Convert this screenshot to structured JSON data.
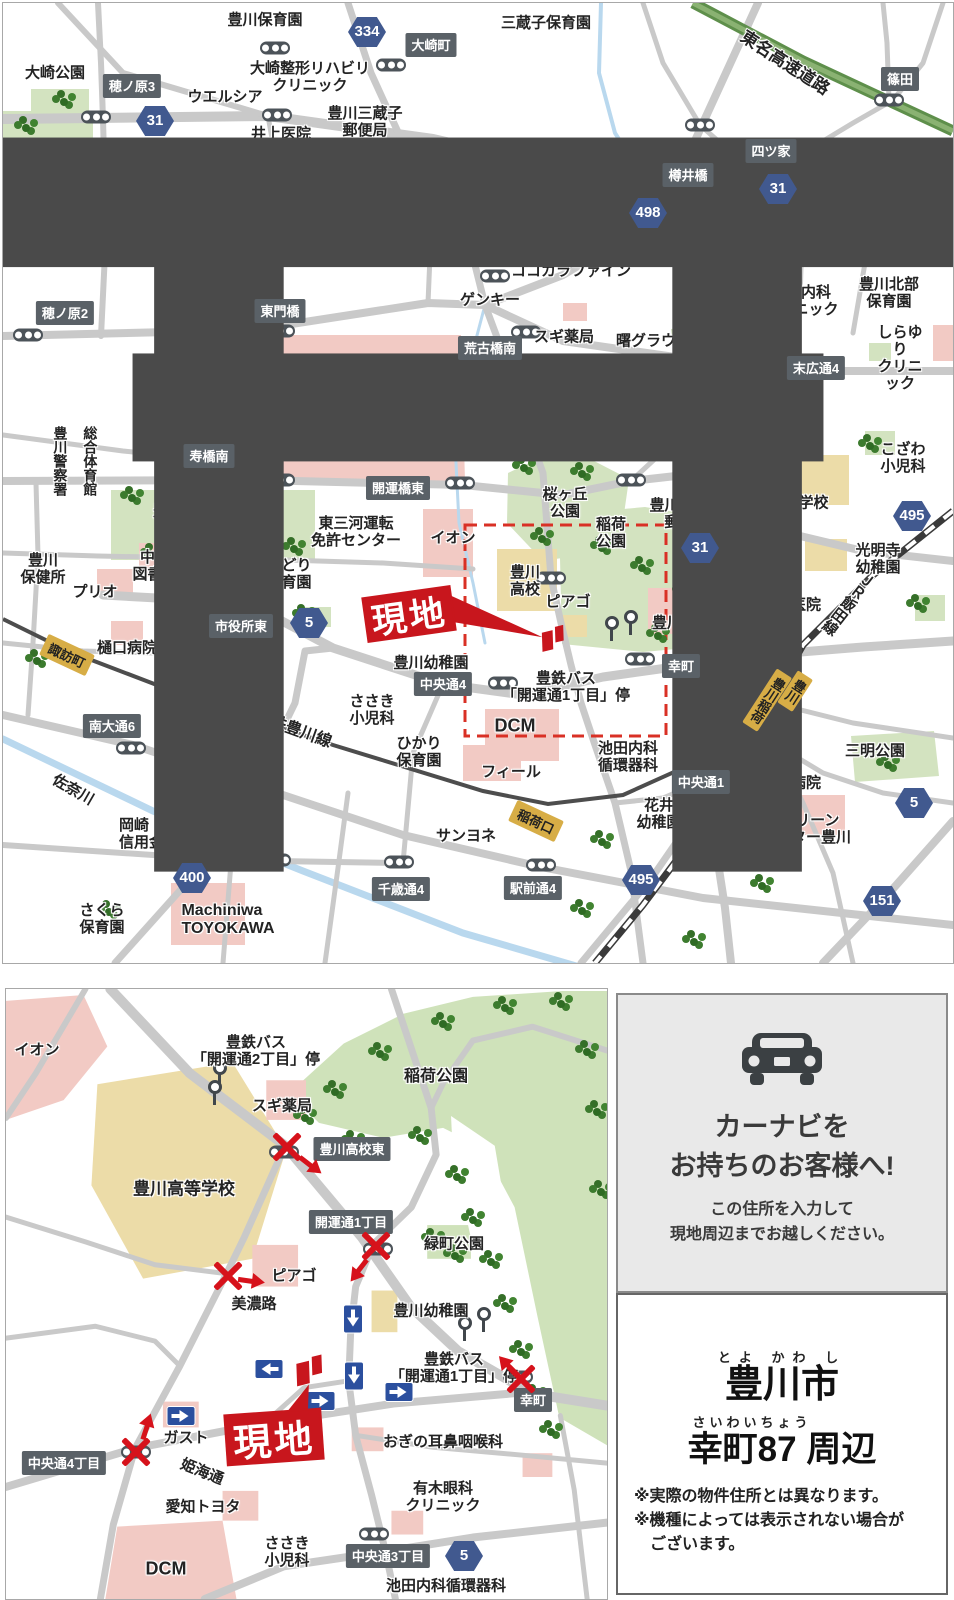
{
  "main_map": {
    "compass": "N",
    "site_label": "現地",
    "labels": [
      {
        "t": "豊川保育園",
        "x": 262,
        "y": 17
      },
      {
        "t": "大崎整形リハビリ\nクリニック",
        "x": 307,
        "y": 74
      },
      {
        "t": "三蔵子保育園",
        "x": 543,
        "y": 20
      },
      {
        "t": "大崎公園",
        "x": 52,
        "y": 70
      },
      {
        "t": "ウエルシア",
        "x": 222,
        "y": 94
      },
      {
        "t": "井上医院",
        "x": 278,
        "y": 131
      },
      {
        "t": "豊川三蔵子\n郵便局",
        "x": 362,
        "y": 119
      },
      {
        "t": "星野内科\n消化器科\nクリニック",
        "x": 352,
        "y": 177
      },
      {
        "t": "豊川\n海軍工廠\n平和公園",
        "x": 45,
        "y": 172,
        "a": "left"
      },
      {
        "t": "福田\n内科",
        "x": 578,
        "y": 198
      },
      {
        "t": "スターバックス\nコーヒー",
        "x": 878,
        "y": 201
      },
      {
        "t": "クック\nマート",
        "x": 450,
        "y": 195
      },
      {
        "t": "三蔵子交番",
        "x": 374,
        "y": 228
      },
      {
        "t": "本野児童遊園",
        "x": 354,
        "y": 256
      },
      {
        "t": "ココカラファイン",
        "x": 568,
        "y": 268
      },
      {
        "t": "ゲンキー",
        "x": 487,
        "y": 297
      },
      {
        "t": "大山内科\nクリニック",
        "x": 798,
        "y": 298
      },
      {
        "t": "豊川北部\n保育園",
        "x": 886,
        "y": 290
      },
      {
        "t": "スギ薬局",
        "x": 561,
        "y": 334
      },
      {
        "t": "曙グラウンド",
        "x": 658,
        "y": 338
      },
      {
        "t": "しらゆり\nクリニック",
        "x": 897,
        "y": 355
      },
      {
        "t": "豊川信用\n金庫",
        "x": 674,
        "y": 385
      },
      {
        "t": "陸上自衛隊\n豊川駐屯地",
        "x": 367,
        "y": 410,
        "s": 17
      },
      {
        "t": "豊川東\n幼稚園",
        "x": 774,
        "y": 408
      },
      {
        "t": "後藤病院",
        "x": 564,
        "y": 423
      },
      {
        "t": "アミカ",
        "x": 499,
        "y": 447
      },
      {
        "t": "大橋医院",
        "x": 729,
        "y": 455
      },
      {
        "t": "こざわ\n小児科",
        "x": 900,
        "y": 455
      },
      {
        "t": "桜ヶ丘\n公園",
        "x": 562,
        "y": 500
      },
      {
        "t": "豊川桜木通\n郵便局",
        "x": 684,
        "y": 511
      },
      {
        "t": "東部中学校",
        "x": 788,
        "y": 500
      },
      {
        "t": "豊川公園",
        "x": 180,
        "y": 508
      },
      {
        "t": "東三河運転\n免許センター",
        "x": 353,
        "y": 529
      },
      {
        "t": "イオン",
        "x": 450,
        "y": 535
      },
      {
        "t": "稲荷\n公園",
        "x": 608,
        "y": 530
      },
      {
        "t": "光明寺\n幼稚園",
        "x": 875,
        "y": 556
      },
      {
        "t": "豊川\n保健所",
        "x": 40,
        "y": 566
      },
      {
        "t": "中央\n図書館",
        "x": 152,
        "y": 563
      },
      {
        "t": "豊川\n市役所",
        "x": 217,
        "y": 563
      },
      {
        "t": "みどり\n保育園",
        "x": 286,
        "y": 571
      },
      {
        "t": "豊川\n高校",
        "x": 522,
        "y": 578
      },
      {
        "t": "プリオ",
        "x": 92,
        "y": 589
      },
      {
        "t": "ピアゴ",
        "x": 565,
        "y": 599
      },
      {
        "t": "豊川稲荷",
        "x": 679,
        "y": 620
      },
      {
        "t": "高橋医院",
        "x": 788,
        "y": 602
      },
      {
        "t": "三菱UFJ\n銀行",
        "x": 765,
        "y": 646,
        "a": "left"
      },
      {
        "t": "樋口病院",
        "x": 124,
        "y": 645
      },
      {
        "t": "豊川幼稚園",
        "x": 428,
        "y": 660
      },
      {
        "t": "豊鉄バス\n「開運通1丁目」停",
        "x": 563,
        "y": 684
      },
      {
        "t": "ささき\n小児科",
        "x": 369,
        "y": 707
      },
      {
        "t": "ひかり\n保育園",
        "x": 416,
        "y": 749
      },
      {
        "t": "DCM",
        "x": 512,
        "y": 723,
        "s": 18
      },
      {
        "t": "豊川\n小学校",
        "x": 707,
        "y": 728
      },
      {
        "t": "三明公園",
        "x": 872,
        "y": 748
      },
      {
        "t": "フィール",
        "x": 508,
        "y": 769
      },
      {
        "t": "池田内科\n循環器科",
        "x": 625,
        "y": 754
      },
      {
        "t": "宮地病院",
        "x": 788,
        "y": 780
      },
      {
        "t": "岡崎\n信用金庫",
        "x": 146,
        "y": 831,
        "a": "left"
      },
      {
        "t": "花井\n幼稚園",
        "x": 656,
        "y": 811
      },
      {
        "t": "JAグリーン\nセンター豊川",
        "x": 803,
        "y": 826,
        "a": "left"
      },
      {
        "t": "サンヨネ",
        "x": 463,
        "y": 833
      },
      {
        "t": "さくら\n保育園",
        "x": 99,
        "y": 916
      },
      {
        "t": "Machiniwa\nTOYOKAWA",
        "x": 225,
        "y": 917,
        "s": 16,
        "a": "left"
      },
      {
        "t": "東名高速道路",
        "x": 782,
        "y": 60,
        "r": 33,
        "s": 17
      },
      {
        "t": "帯川",
        "x": 864,
        "y": 160,
        "r": -25
      },
      {
        "t": "名鉄豊川線",
        "x": 290,
        "y": 727,
        "r": 20,
        "s": 16
      },
      {
        "t": "佐奈川",
        "x": 70,
        "y": 787,
        "r": 30
      },
      {
        "t": "ＪＲ飯田線",
        "x": 845,
        "y": 600,
        "r": 38,
        "v": true
      },
      {
        "t": "豊川警察署",
        "x": 57,
        "y": 458,
        "v": true,
        "s": 14
      },
      {
        "t": "総合体育館",
        "x": 87,
        "y": 458,
        "v": true,
        "s": 14
      }
    ],
    "dark_boxes": [
      {
        "t": "大崎町",
        "x": 428,
        "y": 42
      },
      {
        "t": "穂ノ原3",
        "x": 129,
        "y": 83
      },
      {
        "t": "篠田",
        "x": 897,
        "y": 76
      },
      {
        "t": "四ツ家",
        "x": 768,
        "y": 148
      },
      {
        "t": "樽井橋",
        "x": 685,
        "y": 172
      },
      {
        "t": "穂ノ原2",
        "x": 62,
        "y": 310
      },
      {
        "t": "東門橋",
        "x": 277,
        "y": 308
      },
      {
        "t": "荒古橋南",
        "x": 487,
        "y": 345
      },
      {
        "t": "末広通4",
        "x": 813,
        "y": 365
      },
      {
        "t": "寿橋南",
        "x": 206,
        "y": 453
      },
      {
        "t": "開運橋東",
        "x": 395,
        "y": 485
      },
      {
        "t": "市役所東",
        "x": 238,
        "y": 623
      },
      {
        "t": "幸町",
        "x": 678,
        "y": 663
      },
      {
        "t": "中央通4",
        "x": 440,
        "y": 681
      },
      {
        "t": "南大通6",
        "x": 109,
        "y": 723
      },
      {
        "t": "中央通1",
        "x": 698,
        "y": 779
      },
      {
        "t": "千歳通4",
        "x": 398,
        "y": 886
      },
      {
        "t": "駅前通4",
        "x": 530,
        "y": 885
      }
    ],
    "route_badges": [
      {
        "n": "31",
        "x": 152,
        "y": 118
      },
      {
        "n": "334",
        "x": 364,
        "y": 29
      },
      {
        "n": "498",
        "x": 645,
        "y": 210
      },
      {
        "n": "31",
        "x": 775,
        "y": 186
      },
      {
        "n": "495",
        "x": 909,
        "y": 513
      },
      {
        "n": "31",
        "x": 697,
        "y": 545
      },
      {
        "n": "5",
        "x": 306,
        "y": 620
      },
      {
        "n": "5",
        "x": 911,
        "y": 800
      },
      {
        "n": "400",
        "x": 189,
        "y": 875
      },
      {
        "n": "495",
        "x": 638,
        "y": 877
      },
      {
        "n": "151",
        "x": 879,
        "y": 898
      }
    ],
    "stations": [
      {
        "t": "諏訪町",
        "x": 64,
        "y": 652,
        "r": 25
      },
      {
        "t": "稲荷口",
        "x": 533,
        "y": 818,
        "r": 25
      },
      {
        "t": "豊川稲荷",
        "x": 764,
        "y": 697,
        "r": 33,
        "v": true
      },
      {
        "t": "豊川",
        "x": 792,
        "y": 688,
        "r": 33,
        "v": true
      }
    ],
    "signals": [
      [
        272,
        45
      ],
      [
        388,
        62
      ],
      [
        93,
        114
      ],
      [
        274,
        112
      ],
      [
        886,
        97
      ],
      [
        697,
        122
      ],
      [
        764,
        172
      ],
      [
        705,
        200
      ],
      [
        492,
        273
      ],
      [
        523,
        329
      ],
      [
        783,
        343
      ],
      [
        707,
        413
      ],
      [
        25,
        332
      ],
      [
        277,
        328
      ],
      [
        200,
        478
      ],
      [
        277,
        477
      ],
      [
        457,
        480
      ],
      [
        628,
        477
      ],
      [
        548,
        575
      ],
      [
        772,
        527
      ],
      [
        715,
        649
      ],
      [
        500,
        680
      ],
      [
        637,
        656
      ],
      [
        245,
        599
      ],
      [
        128,
        745
      ],
      [
        712,
        753
      ],
      [
        273,
        857
      ],
      [
        396,
        859
      ],
      [
        538,
        862
      ],
      [
        235,
        783
      ]
    ],
    "bus_stops": [
      [
        608,
        628
      ],
      [
        627,
        622
      ]
    ],
    "tree_clusters": [
      [
        62,
        96
      ],
      [
        24,
        122
      ],
      [
        40,
        160
      ],
      [
        66,
        192
      ],
      [
        22,
        204
      ],
      [
        130,
        492
      ],
      [
        178,
        490
      ],
      [
        238,
        496
      ],
      [
        292,
        543
      ],
      [
        205,
        552
      ],
      [
        150,
        549
      ],
      [
        522,
        462
      ],
      [
        580,
        468
      ],
      [
        540,
        533
      ],
      [
        600,
        542
      ],
      [
        640,
        562
      ],
      [
        682,
        586
      ],
      [
        656,
        630
      ],
      [
        700,
        556
      ],
      [
        748,
        334
      ],
      [
        886,
        759
      ],
      [
        868,
        440
      ],
      [
        916,
        600
      ],
      [
        302,
        610
      ],
      [
        760,
        880
      ],
      [
        692,
        936
      ],
      [
        600,
        836
      ],
      [
        35,
        655
      ],
      [
        107,
        906
      ],
      [
        580,
        905
      ]
    ]
  },
  "detail_map": {
    "site_label": "現地",
    "labels": [
      {
        "t": "イオン",
        "x": 31,
        "y": 61
      },
      {
        "t": "豊鉄バス\n「開運通2丁目」停",
        "x": 250,
        "y": 62
      },
      {
        "t": "スギ薬局",
        "x": 276,
        "y": 117
      },
      {
        "t": "豊川高等学校",
        "x": 178,
        "y": 200,
        "s": 17
      },
      {
        "t": "稲荷公園",
        "x": 430,
        "y": 88,
        "s": 16
      },
      {
        "t": "美濃路",
        "x": 248,
        "y": 315
      },
      {
        "t": "ピアゴ",
        "x": 288,
        "y": 287
      },
      {
        "t": "緑町公園",
        "x": 448,
        "y": 255
      },
      {
        "t": "豊川幼稚園",
        "x": 425,
        "y": 322
      },
      {
        "t": "豊鉄バス\n「開運通1丁目」停",
        "x": 448,
        "y": 379
      },
      {
        "t": "おぎの耳鼻咽喉科",
        "x": 437,
        "y": 453
      },
      {
        "t": "有木眼科\nクリニック",
        "x": 437,
        "y": 508
      },
      {
        "t": "ささき\n小児科",
        "x": 281,
        "y": 563
      },
      {
        "t": "池田内科循環器科",
        "x": 440,
        "y": 597
      },
      {
        "t": "ガスト",
        "x": 180,
        "y": 449
      },
      {
        "t": "姫海通",
        "x": 196,
        "y": 483,
        "r": 22
      },
      {
        "t": "愛知トヨタ",
        "x": 197,
        "y": 518
      },
      {
        "t": "DCM",
        "x": 160,
        "y": 580,
        "s": 18
      }
    ],
    "dark_boxes": [
      {
        "t": "豊川高校東",
        "x": 346,
        "y": 160
      },
      {
        "t": "開運通1丁目",
        "x": 345,
        "y": 233
      },
      {
        "t": "幸町",
        "x": 527,
        "y": 411
      },
      {
        "t": "中央通3丁目",
        "x": 382,
        "y": 567
      },
      {
        "t": "中央通4丁目",
        "x": 58,
        "y": 474
      }
    ],
    "route_badges": [
      {
        "n": "5",
        "x": 458,
        "y": 567
      }
    ],
    "stations": [],
    "signals": [
      [
        278,
        163
      ],
      [
        372,
        260
      ],
      [
        512,
        388
      ],
      [
        368,
        545
      ],
      [
        130,
        463
      ]
    ],
    "bus_stops": [
      [
        213,
        87
      ],
      [
        208,
        106
      ],
      [
        458,
        342
      ],
      [
        477,
        333
      ]
    ],
    "tree_clusters": [
      [
        330,
        100
      ],
      [
        375,
        62
      ],
      [
        438,
        32
      ],
      [
        500,
        16
      ],
      [
        556,
        12
      ],
      [
        300,
        126
      ],
      [
        348,
        150
      ],
      [
        415,
        146
      ],
      [
        452,
        185
      ],
      [
        468,
        228
      ],
      [
        486,
        270
      ],
      [
        500,
        314
      ],
      [
        516,
        360
      ],
      [
        530,
        404
      ],
      [
        546,
        440
      ],
      [
        428,
        248
      ],
      [
        450,
        264
      ],
      [
        582,
        60
      ],
      [
        592,
        120
      ],
      [
        596,
        200
      ]
    ],
    "one_way_arrows": [
      {
        "x": 347,
        "y": 330,
        "r": 90
      },
      {
        "x": 263,
        "y": 380,
        "r": 180
      },
      {
        "x": 348,
        "y": 387,
        "r": 90
      },
      {
        "x": 393,
        "y": 403,
        "r": 0
      },
      {
        "x": 315,
        "y": 412,
        "r": 0
      },
      {
        "x": 175,
        "y": 427,
        "r": 0
      }
    ],
    "no_entry": [
      {
        "x": 281,
        "y": 158,
        "ax": 306,
        "ay": 177,
        "r": 38
      },
      {
        "x": 370,
        "y": 257,
        "ax": 352,
        "ay": 283,
        "r": 128
      },
      {
        "x": 222,
        "y": 287,
        "ax": 247,
        "ay": 292,
        "r": 8
      },
      {
        "x": 130,
        "y": 463,
        "ax": 141,
        "ay": 436,
        "r": -72
      },
      {
        "x": 515,
        "y": 390,
        "ax": 501,
        "ay": 376,
        "r": -132
      }
    ]
  },
  "sidebar": {
    "navi": {
      "title": "カーナビを\nお持ちのお客様へ!",
      "note": "この住所を入力して\n現地周辺までお越しください。"
    },
    "address": {
      "furigana_city": "とよ かわ し",
      "city": "豊川市",
      "furigana_town": "さいわいちょう",
      "town": "幸町87 周辺",
      "notes": [
        "※実際の物件住所とは異なります。",
        "※機種によっては表示されない場合が\nございます。"
      ]
    }
  }
}
